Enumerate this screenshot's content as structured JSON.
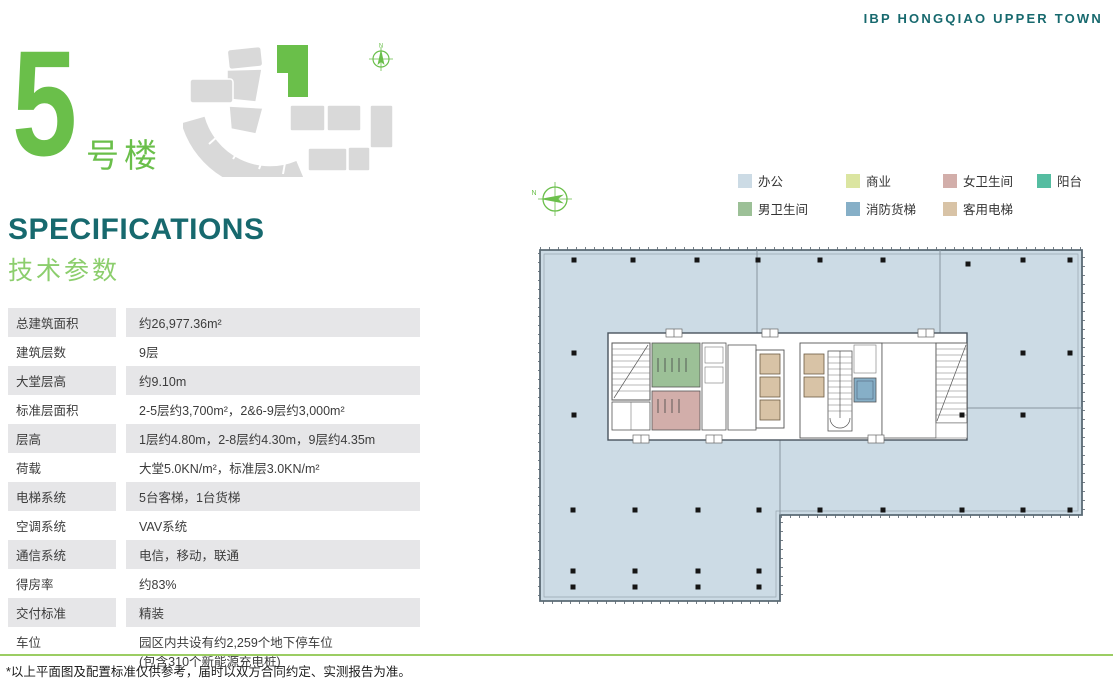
{
  "brand": "IBP HONGQIAO UPPER TOWN",
  "building": {
    "number": "5",
    "suffix": "号楼"
  },
  "section": {
    "title_en": "SPECIFICATIONS",
    "title_zh": "技术参数"
  },
  "specs": {
    "rows": [
      {
        "label": "总建筑面积",
        "value": "约26,977.36m²"
      },
      {
        "label": "建筑层数",
        "value": "9层"
      },
      {
        "label": "大堂层高",
        "value": "约9.10m"
      },
      {
        "label": "标准层面积",
        "value": "2-5层约3,700m²，2&6-9层约3,000m²"
      },
      {
        "label": "层高",
        "value": "1层约4.80m，2-8层约4.30m，9层约4.35m"
      },
      {
        "label": "荷载",
        "value": "大堂5.0KN/m²，标准层3.0KN/m²"
      },
      {
        "label": "电梯系统",
        "value": "5台客梯，1台货梯"
      },
      {
        "label": "空调系统",
        "value": "VAV系统"
      },
      {
        "label": "通信系统",
        "value": "电信，移动，联通"
      },
      {
        "label": "得房率",
        "value": "约83%"
      },
      {
        "label": "交付标准",
        "value": "精装"
      },
      {
        "label": "车位",
        "value": "园区内共设有约2,259个地下停车位",
        "value2": "(包含310个新能源充电桩)"
      }
    ]
  },
  "legend": {
    "items": [
      {
        "label": "办公",
        "color": "#ccdbe5"
      },
      {
        "label": "商业",
        "color": "#dbe5a1"
      },
      {
        "label": "女卫生间",
        "color": "#d2aeaa"
      },
      {
        "label": "阳台",
        "color": "#55bda1"
      },
      {
        "label": "男卫生间",
        "color": "#9cc097"
      },
      {
        "label": "消防货梯",
        "color": "#86afc7"
      },
      {
        "label": "客用电梯",
        "color": "#d8c3a6"
      }
    ]
  },
  "compass": {
    "label": "N"
  },
  "footer": {
    "note": "*以上平面图及配置标准仅供参考，届时以双方合同约定、实测报告为准。"
  },
  "colors": {
    "brand_teal": "#17696e",
    "accent_green": "#6abf4a",
    "light_green": "#8cce6d",
    "footer_line_green": "#9bcd63",
    "office_fill": "#ccdbe5",
    "siteplan_gray": "#d9d9d9"
  }
}
